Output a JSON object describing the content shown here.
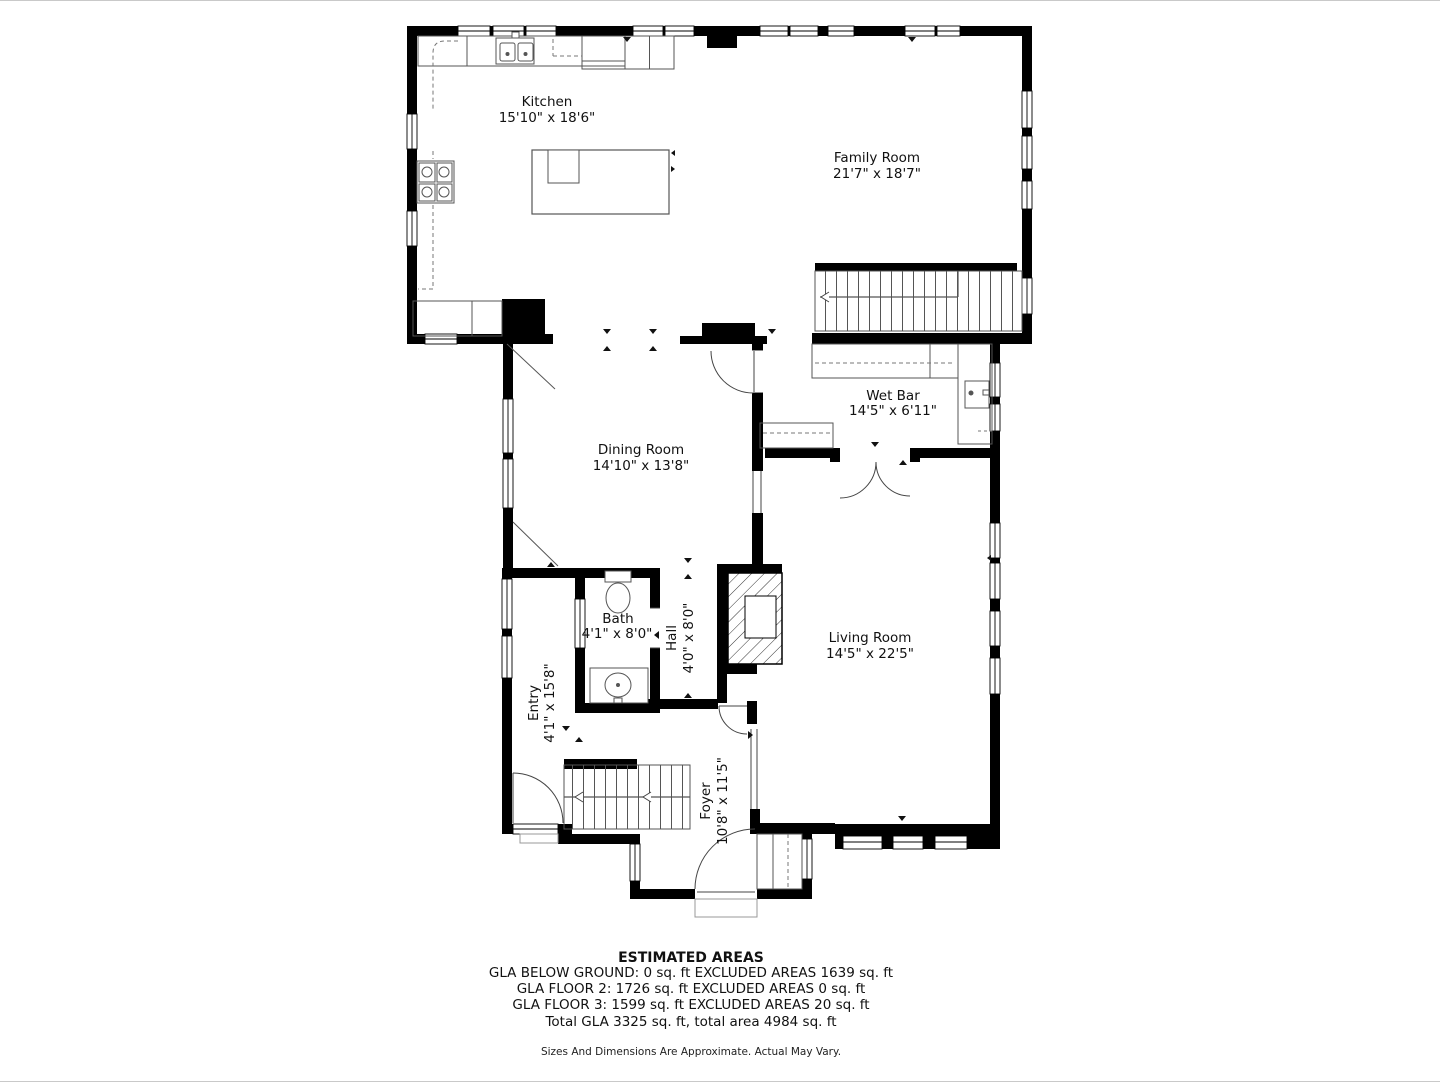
{
  "rooms": {
    "kitchen": {
      "name": "Kitchen",
      "dims": "15'10\" x 18'6\""
    },
    "family": {
      "name": "Family Room",
      "dims": "21'7\" x 18'7\""
    },
    "wetbar": {
      "name": "Wet Bar",
      "dims": "14'5\" x 6'11\""
    },
    "dining": {
      "name": "Dining Room",
      "dims": "14'10\" x 13'8\""
    },
    "bath": {
      "name": "Bath",
      "dims": "4'1\" x 8'0\""
    },
    "hall": {
      "name": "Hall",
      "dims": "4'0\" x 8'0\""
    },
    "living": {
      "name": "Living Room",
      "dims": "14'5\" x 22'5\""
    },
    "entry": {
      "name": "Entry",
      "dims": "4'1\" x 15'8\""
    },
    "foyer": {
      "name": "Foyer",
      "dims": "10'8\" x 11'5\""
    }
  },
  "areas": {
    "title": "ESTIMATED AREAS",
    "line1": "GLA BELOW GROUND: 0 sq. ft EXCLUDED AREAS 1639 sq. ft",
    "line2": "GLA FLOOR 2: 1726 sq. ft EXCLUDED AREAS 0 sq. ft",
    "line3": "GLA FLOOR 3: 1599 sq. ft EXCLUDED AREAS 20 sq. ft",
    "line4": "Total GLA 3325 sq. ft, total area 4984 sq. ft",
    "disclaimer": "Sizes And Dimensions Are Approximate. Actual May Vary."
  },
  "colors": {
    "wall": "#000000",
    "line": "#4d4d4d",
    "text": "#111111",
    "background": "#ffffff",
    "page_border": "#c9c9c9"
  }
}
